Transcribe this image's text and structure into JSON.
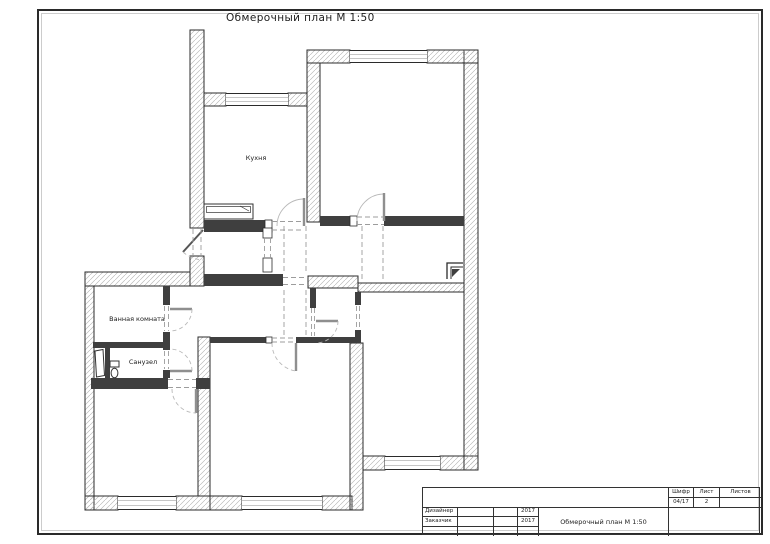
{
  "page": {
    "title": "Обмерочный план М 1:50"
  },
  "rooms": {
    "kitchen": "Кухня",
    "bathroom": "Ванная комната",
    "wc": "Санузел"
  },
  "title_block": {
    "doc_title": "Обмерочный план М 1:50",
    "stamp": {
      "code_label": "Шифр",
      "code_value": "04/17",
      "sheet_label": "Лист",
      "sheet_value": "2",
      "sheets_label": "Листов",
      "sheets_value": ""
    },
    "rows": [
      {
        "label": "Дизайнер",
        "year": "2017"
      },
      {
        "label": "Заказчик",
        "year": "2017"
      }
    ]
  },
  "colors": {
    "line": "#2b2b2b",
    "hatch": "#b0b0b0",
    "glass": "#c6c6c6"
  }
}
